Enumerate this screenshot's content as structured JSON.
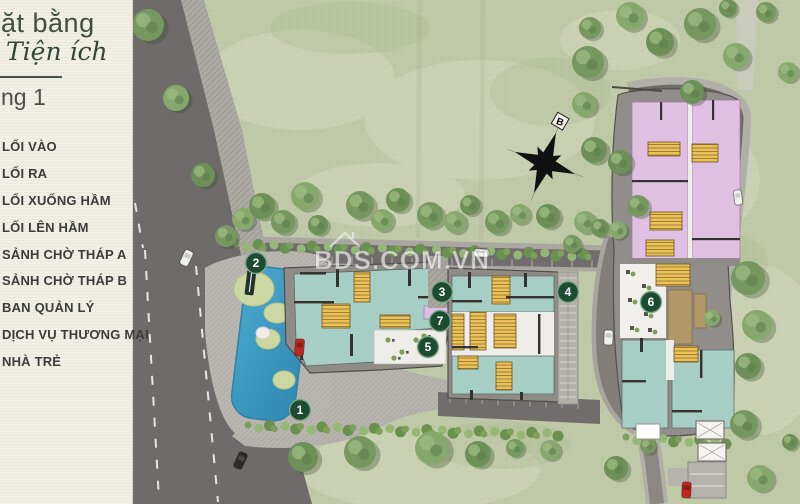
{
  "sidebar": {
    "title_line1": "ặt bằng",
    "title_line2": "Tiện ích",
    "floor_label": "ng 1",
    "items": [
      "LỐI VÀO",
      "LỐI RA",
      "LỐI XUỐNG HẦM",
      "LỐI LÊN HẦM",
      "SẢNH CHỜ THÁP A",
      "SẢNH CHỜ THÁP B",
      "BAN QUẢN LÝ",
      "DỊCH VỤ THƯƠNG MẠI",
      "NHÀ TRẺ"
    ],
    "text_color": "#3c3c39"
  },
  "map": {
    "watermark": "BDS.COM.VN",
    "compass_label": "B",
    "markers": [
      "1",
      "2",
      "3",
      "4",
      "5",
      "6",
      "7"
    ],
    "colors": {
      "lawn": "#bfc9a7",
      "road": "#6f6b6a",
      "sidewalk": "#b2afa9",
      "pool_blue": "#3f9fc6",
      "room_teal": "#a7cec5",
      "core_yellow": "#eac258",
      "room_pink": "#e0c0e2",
      "room_tan": "#b29768",
      "marker_green": "#1d4b31"
    }
  }
}
